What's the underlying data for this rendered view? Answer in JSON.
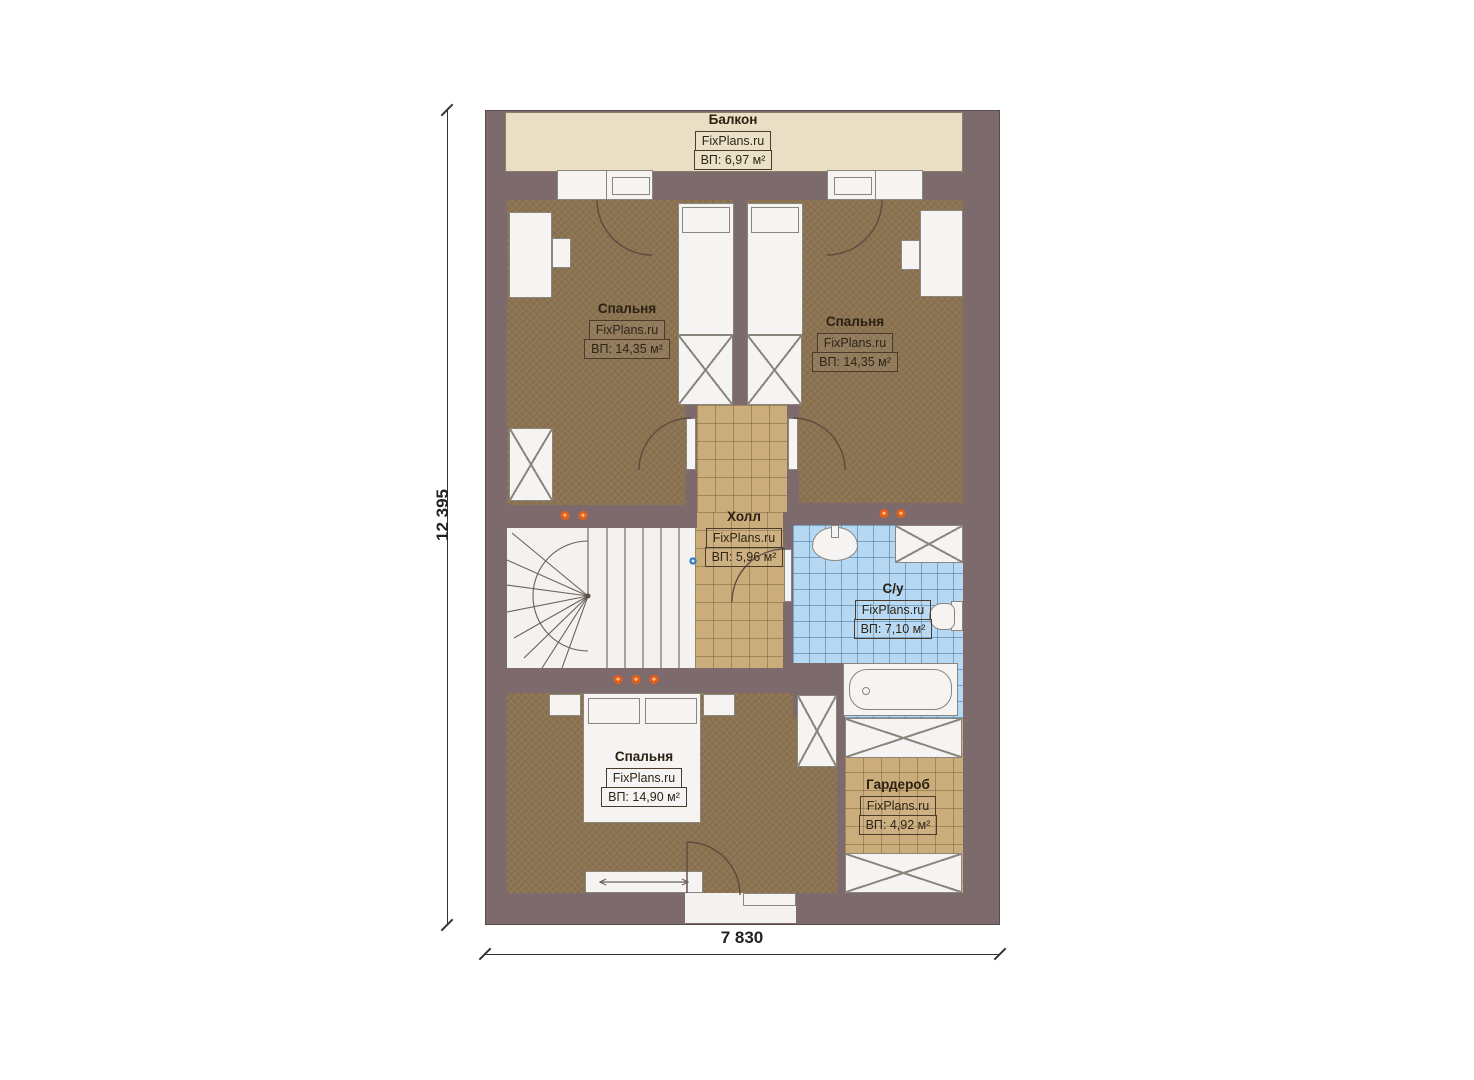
{
  "dimensions": {
    "vertical": "12 395",
    "horizontal": "7 830"
  },
  "rooms": {
    "balcony": {
      "name": "Балкон",
      "brand": "FixPlans.ru",
      "area": "ВП: 6,97 м²"
    },
    "bedroom_top_left": {
      "name": "Спальня",
      "brand": "FixPlans.ru",
      "area": "ВП: 14,35 м²"
    },
    "bedroom_top_right": {
      "name": "Спальня",
      "brand": "FixPlans.ru",
      "area": "ВП: 14,35 м²"
    },
    "hall": {
      "name": "Холл",
      "brand": "FixPlans.ru",
      "area": "ВП: 5,96 м²"
    },
    "bathroom": {
      "name": "С/у",
      "brand": "FixPlans.ru",
      "area": "ВП: 7,10 м²"
    },
    "bedroom_bottom": {
      "name": "Спальня",
      "brand": "FixPlans.ru",
      "area": "ВП: 14,90 м²"
    },
    "wardrobe": {
      "name": "Гардероб",
      "brand": "FixPlans.ru",
      "area": "ВП: 4,92 м²"
    }
  },
  "colors": {
    "wall": "#7d6a6c",
    "balcony_floor": "#eadfc5",
    "bedroom_floor": "#8b7352",
    "hall_floor": "#cbad7c",
    "bathroom_floor": "#b6d8f3",
    "accent_dot_orange": "#e2601c",
    "accent_dot_blue": "#3f7fc4"
  }
}
